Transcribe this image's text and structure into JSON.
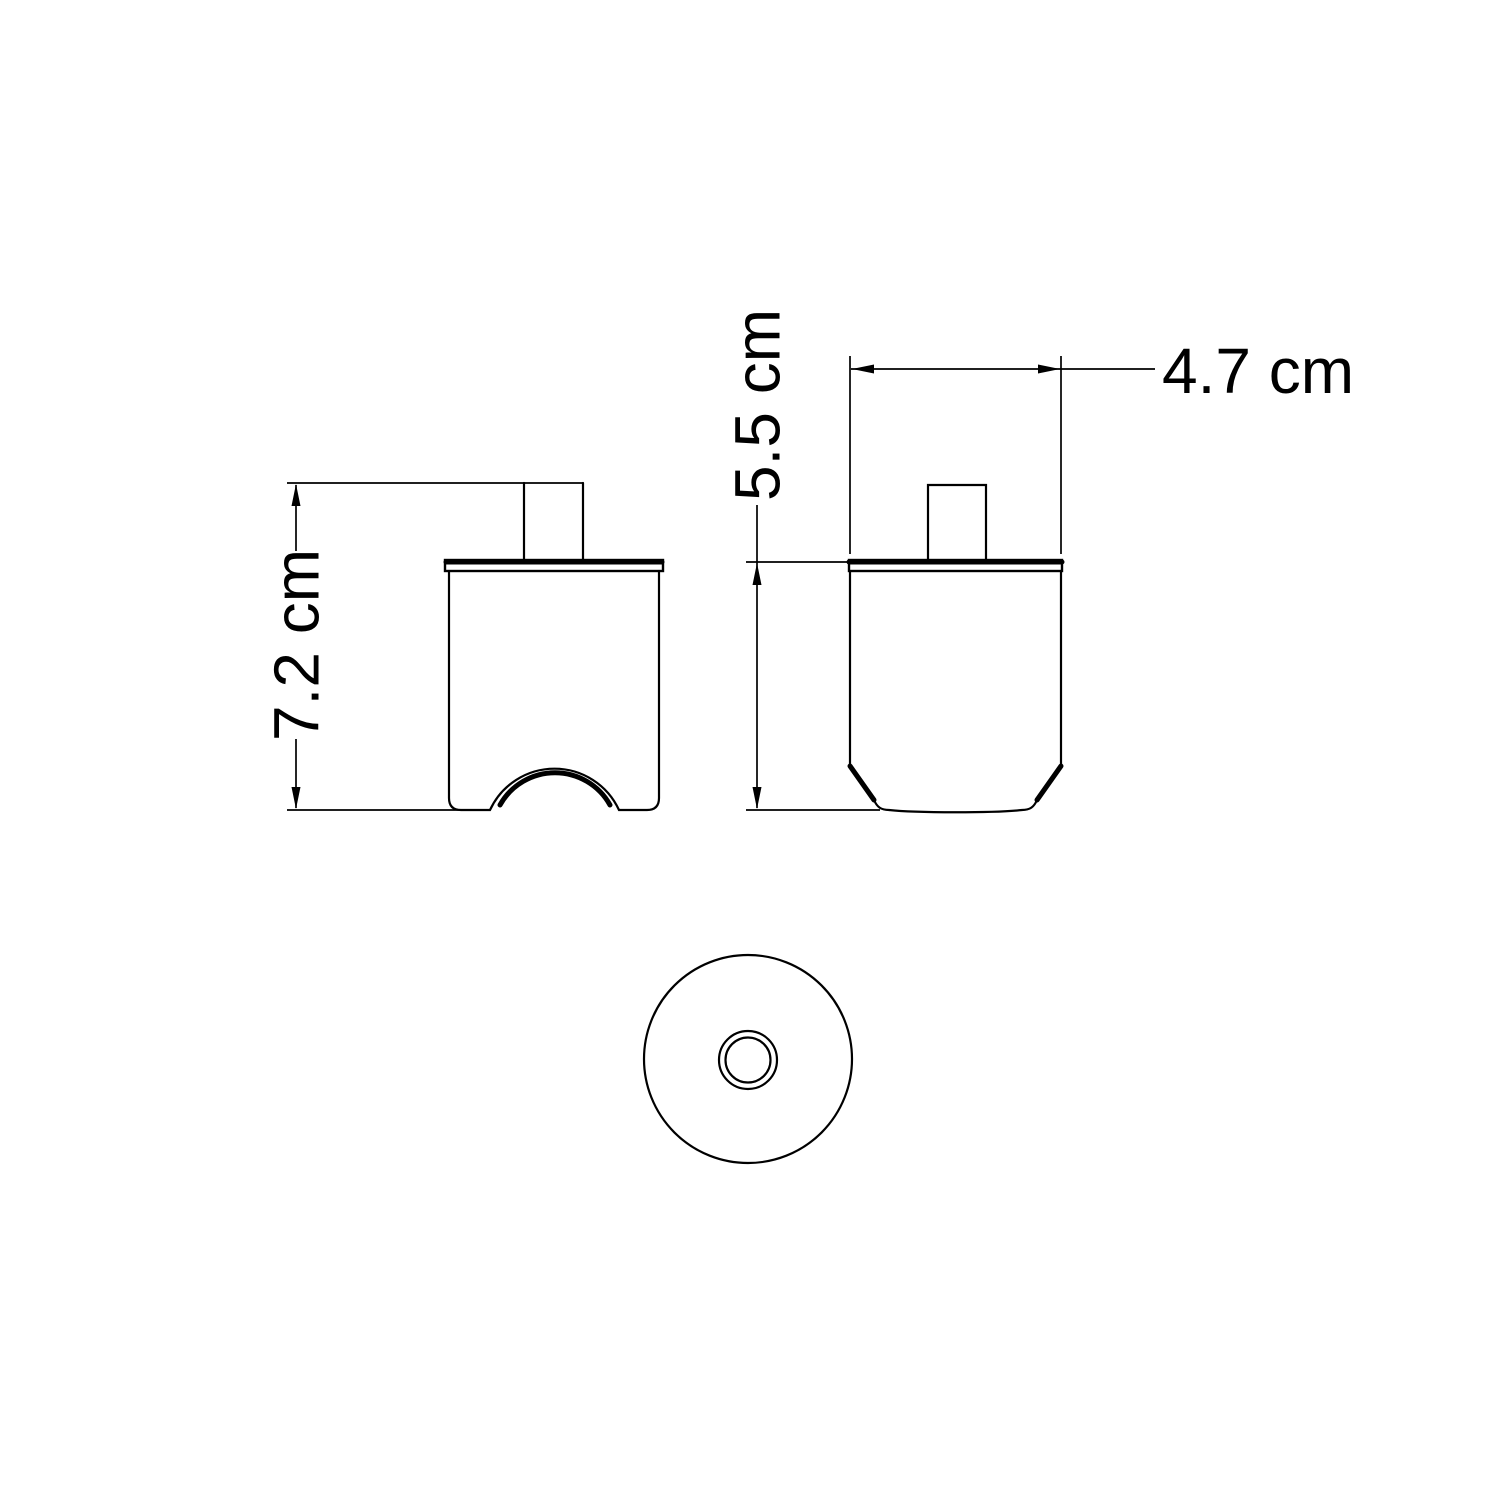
{
  "diagram": {
    "background_color": "#ffffff",
    "line_color": "#000000",
    "dimensions": {
      "front_height": {
        "label": "7.2 cm",
        "orientation": "vertical"
      },
      "side_height": {
        "label": "5.5 cm",
        "orientation": "vertical"
      },
      "side_width": {
        "label": "4.7 cm",
        "orientation": "horizontal"
      }
    }
  }
}
